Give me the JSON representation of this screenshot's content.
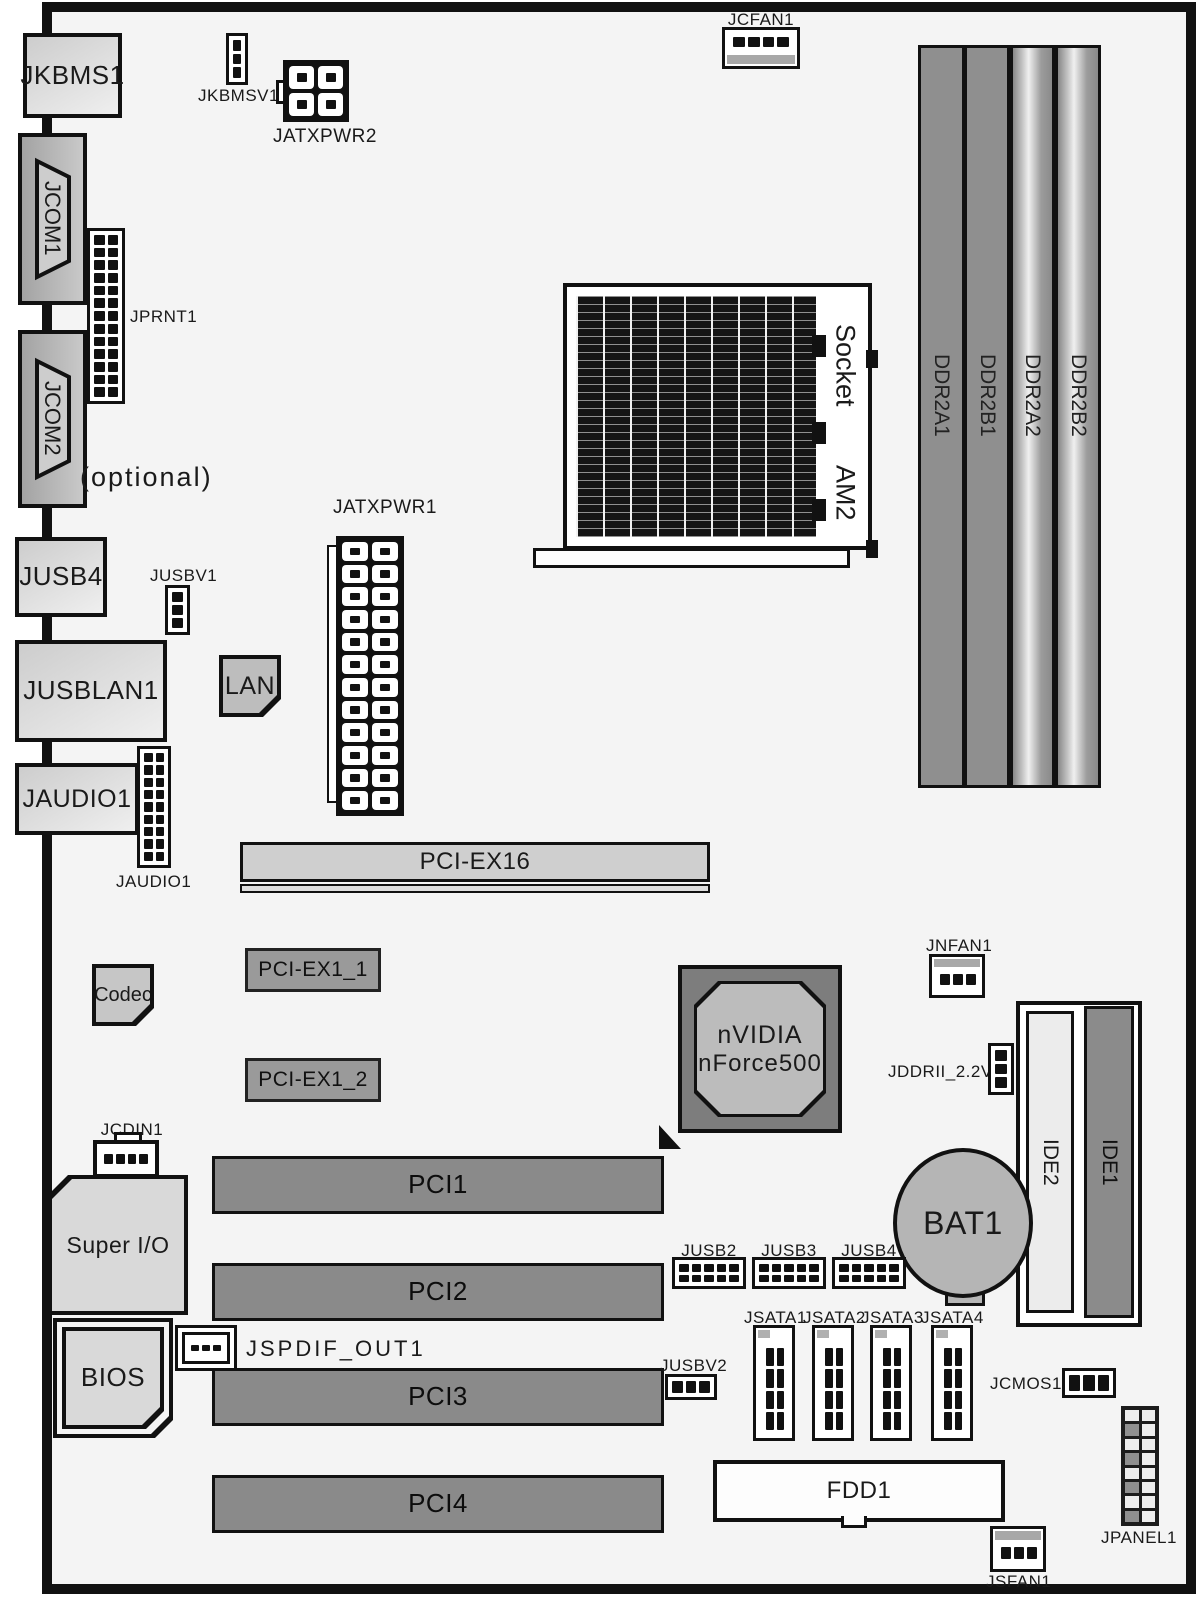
{
  "colors": {
    "board_bg": "#f4f4f4",
    "outline": "#111111",
    "slot_dark": "#8a8a8a",
    "pciex16_fill": "#cfcfcf",
    "pciex1_fill": "#9a9a9a",
    "io_box_fill": "#e0e0e0",
    "com_port_fill": "#b4b4b4",
    "chip_fill": "#c2c2c2",
    "nvidia_outer": "#7d7d7d",
    "nvidia_inner": "#bcbcbc",
    "ide1_fill": "#8b8b8b",
    "ide2_fill": "#ececec",
    "battery_fill": "#b5b5b5",
    "fan_strip": "#a8a8a8"
  },
  "io_panel": {
    "jkbms1": "JKBMS1",
    "jcom1": "JCOM1",
    "jcom2": "JCOM2",
    "optional_note": "(optional)",
    "jusb4": "JUSB4",
    "jusblan1": "JUSBLAN1",
    "jaudio1": "JAUDIO1"
  },
  "headers": {
    "jkbmsv1": "JKBMSV1",
    "jatxpwr2": "JATXPWR2",
    "jcfan1": "JCFAN1",
    "jprnt1": "JPRNT1",
    "jusbv1": "JUSBV1",
    "jatxpwr1": "JATXPWR1",
    "jaudio1": "JAUDIO1",
    "jcdin1": "JCDIN1",
    "jspdif_out1": "JSPDIF_OUT1",
    "jnfan1": "JNFAN1",
    "jddrii_2_2v": "JDDRII_2.2V",
    "jusb2": "JUSB2",
    "jusb3": "JUSB3",
    "jusb4": "JUSB4",
    "jusbv2": "JUSBV2",
    "jcmos1": "JCMOS1",
    "jpanel1": "JPANEL1",
    "jsfan1": "JSFAN1",
    "jsata": [
      "JSATA1",
      "JSATA2",
      "JSATA3",
      "JSATA4"
    ]
  },
  "chips": {
    "lan": "LAN",
    "codec": "Codec",
    "super_io": "Super I/O",
    "bios": "BIOS",
    "nvidia_line1": "nVIDIA",
    "nvidia_line2": "nForce500",
    "battery": "BAT1"
  },
  "cpu_socket": {
    "word1": "Socket",
    "word2": "AM2"
  },
  "memory_slots": [
    "DDR2A1",
    "DDR2B1",
    "DDR2A2",
    "DDR2B2"
  ],
  "expansion_slots": {
    "pciex16": "PCI-EX16",
    "pciex1_1": "PCI-EX1_1",
    "pciex1_2": "PCI-EX1_2",
    "pci1": "PCI1",
    "pci2": "PCI2",
    "pci3": "PCI3",
    "pci4": "PCI4"
  },
  "storage": {
    "ide1": "IDE1",
    "ide2": "IDE2",
    "fdd1": "FDD1"
  }
}
